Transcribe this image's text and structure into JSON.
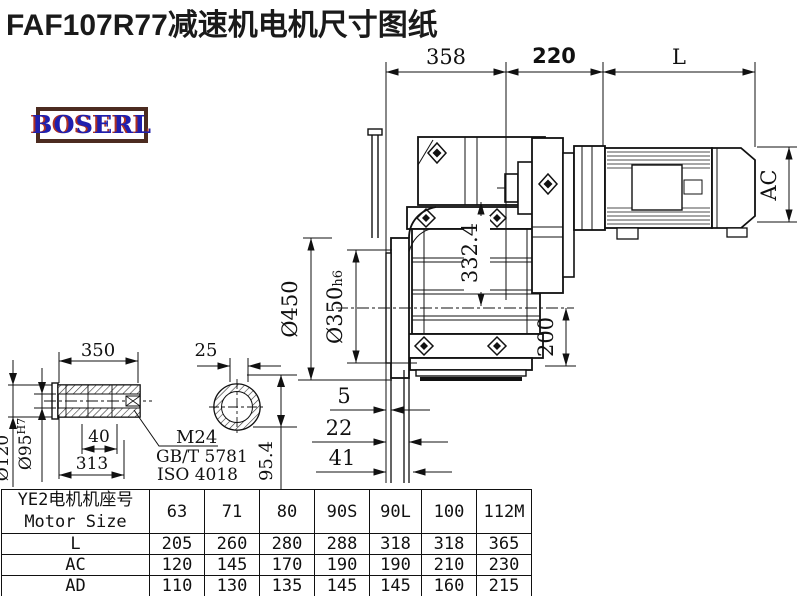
{
  "title": "FAF107R77减速机电机尺寸图纸",
  "logo": {
    "text": "BOSERL",
    "border_color": "#4c2b20",
    "text_color": "#1f1fae",
    "accent_color": "#b03020"
  },
  "drawing": {
    "dim_358": "358",
    "dim_220": "220",
    "dim_L": "L",
    "dim_AC": "AC",
    "dim_450": "Ø450",
    "dim_350": "Ø350",
    "dim_350_tol": "h6",
    "dim_332": "332.4",
    "dim_200": "200",
    "dim_5": "5",
    "dim_22": "22",
    "dim_41": "41",
    "dim_954": "95.4",
    "shaft": {
      "dim_350len": "350",
      "dim_25": "25",
      "dim_120": "Ø120",
      "dim_95": "Ø95",
      "dim_95_tol": "H7",
      "dim_40": "40",
      "dim_313": "313",
      "thread": "M24",
      "std1": "GB/T 5781",
      "std2": "ISO 4018"
    }
  },
  "table": {
    "header_cn": "YE2电机机座号",
    "header_en": "Motor Size",
    "sizes": [
      "63",
      "71",
      "80",
      "90S",
      "90L",
      "100",
      "112M"
    ],
    "rows": [
      {
        "label": "L",
        "values": [
          "205",
          "260",
          "280",
          "288",
          "318",
          "318",
          "365"
        ]
      },
      {
        "label": "AC",
        "values": [
          "120",
          "145",
          "170",
          "190",
          "190",
          "210",
          "230"
        ]
      },
      {
        "label": "AD",
        "values": [
          "110",
          "130",
          "135",
          "145",
          "145",
          "160",
          "215"
        ]
      }
    ]
  }
}
